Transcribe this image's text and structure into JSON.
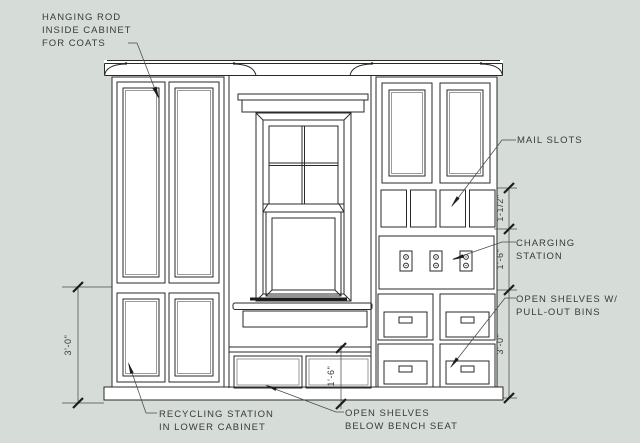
{
  "drawing": {
    "annotations": {
      "hanging_rod": [
        "HANGING ROD",
        "INSIDE CABINET",
        "FOR COATS"
      ],
      "mail_slots": [
        "MAIL SLOTS"
      ],
      "charging_station": [
        "CHARGING",
        "STATION"
      ],
      "pullout_bins": [
        "OPEN SHELVES W/",
        "PULL-OUT BINS"
      ],
      "recycling": [
        "RECYCLING STATION",
        "IN LOWER CABINET"
      ],
      "bench_shelves": [
        "OPEN SHELVES",
        "BELOW BENCH SEAT"
      ]
    },
    "dimensions": {
      "left_height": "3'-0\"",
      "slot_row_height": "1-1/2\"",
      "charging_row_height": "1'-6\"",
      "bench_row_height": "1'-6\"",
      "right_lower_height": "3'-0\""
    },
    "colors": {
      "background": "#d6dcd7",
      "paper": "#ffffff",
      "line": "#2a2a2a",
      "line_light": "#707070",
      "dimline": "#4a4a4a",
      "text": "#3a3a3a"
    }
  }
}
